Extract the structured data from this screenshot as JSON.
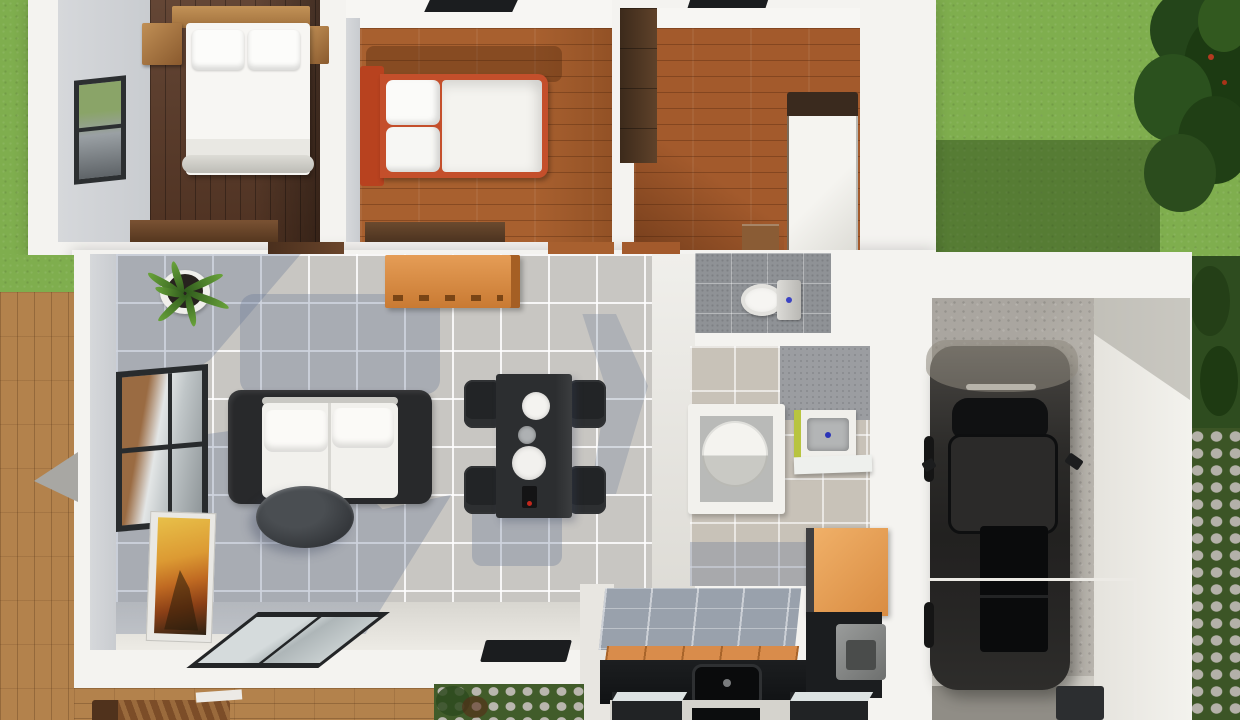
{
  "scene": {
    "type": "3d-floor-plan-render",
    "view": "top-down aerial",
    "description": "Photorealistic 3D render of a single-storey house floor plan with garage, lawn and wooden deck",
    "visible_text": "none"
  },
  "palette": {
    "grass": "#7fae4e",
    "grass_shadow": "#2f4a1c",
    "tree_canopy": "#1f3a14",
    "deck_wood": "#b3824c",
    "exterior_wall": "#f4f3f0",
    "interior_wall_face": "#d0d3d6",
    "bedroom1_floor": "#583826",
    "bedroom2_floor": "#a8602f",
    "bedroom3_floor": "#a35a2c",
    "living_tile": "#c8c6c2",
    "tile_shadow_blue": "#60728e",
    "wc_tile": "#8f9296",
    "bathroom_tile": "#c8c2b8",
    "bed_accent_red": "#c44f2b",
    "sofa_frame_black": "#28292b",
    "cushion_white": "#f2f1ed",
    "kitchen_counter": "#17191b",
    "kitchen_cabinet_orange": "#e9a55e",
    "backsplash_orange": "#d98c4b",
    "vanity_lime": "#b8c43f",
    "garage_concrete": "#b7b3ac",
    "car_body": "#2c2b29"
  },
  "rooms": [
    {
      "id": "bedroom-1",
      "label": "Bedroom 1 (top-left)",
      "floor": "dark walnut wood"
    },
    {
      "id": "bedroom-2",
      "label": "Bedroom 2 (top-middle)",
      "floor": "orange-brown wood"
    },
    {
      "id": "bedroom-3",
      "label": "Bedroom 3 / utility (top-right)",
      "floor": "orange-brown wood"
    },
    {
      "id": "living-room",
      "label": "Living + dining room",
      "floor": "gray ceramic tile"
    },
    {
      "id": "wc",
      "label": "Toilet room",
      "floor": "dark gray tile"
    },
    {
      "id": "bathroom",
      "label": "Bathroom",
      "floor": "beige tile"
    },
    {
      "id": "kitchen",
      "label": "Kitchen (bottom)",
      "floor": "light tile"
    },
    {
      "id": "garage",
      "label": "Garage",
      "floor": "concrete"
    }
  ],
  "furniture": {
    "bedroom1": [
      "double bed with two pillows",
      "wood headboard shelf",
      "two wood nightstands",
      "wood dresser",
      "window on west wall"
    ],
    "bedroom2": [
      "double bed with red frame",
      "white duvet",
      "two stacked pillows",
      "dark dresser",
      "roof skylight"
    ],
    "bedroom3": [
      "dark wardrobe",
      "tall white cabinet with dark top",
      "wood step",
      "roof skylight"
    ],
    "living": [
      "black-frame sofa with white cushions",
      "oval dark coffee table",
      "potted plant",
      "orange sideboard",
      "framed artwork leaning on wall",
      "window on west wall",
      "sliding glass door",
      "black doormat"
    ],
    "dining": [
      "dark rectangular table",
      "four black chairs",
      "two white plates",
      "gray bowl",
      "small dark utensil with red dot"
    ],
    "wc": [
      "toilet with cistern"
    ],
    "bathroom": [
      "square shower with round tray",
      "vanity basin with lime side",
      "white counter"
    ],
    "kitchen": [
      "black L-counter with sink",
      "orange tile backsplash",
      "tall orange cabinet",
      "gray appliance",
      "two island units with light tops",
      "black cooktop"
    ],
    "garage": [
      "dark sedan car",
      "railing",
      "dark bin"
    ]
  },
  "outdoor": [
    "lawn with tree (top-right)",
    "lawn shadow patch",
    "wooden deck (left)",
    "gray parasol triangle",
    "lounge chair (bottom deck)",
    "garden stones and plants (bottom)",
    "stepping-stone path (right)",
    "hedge strip (right)"
  ]
}
